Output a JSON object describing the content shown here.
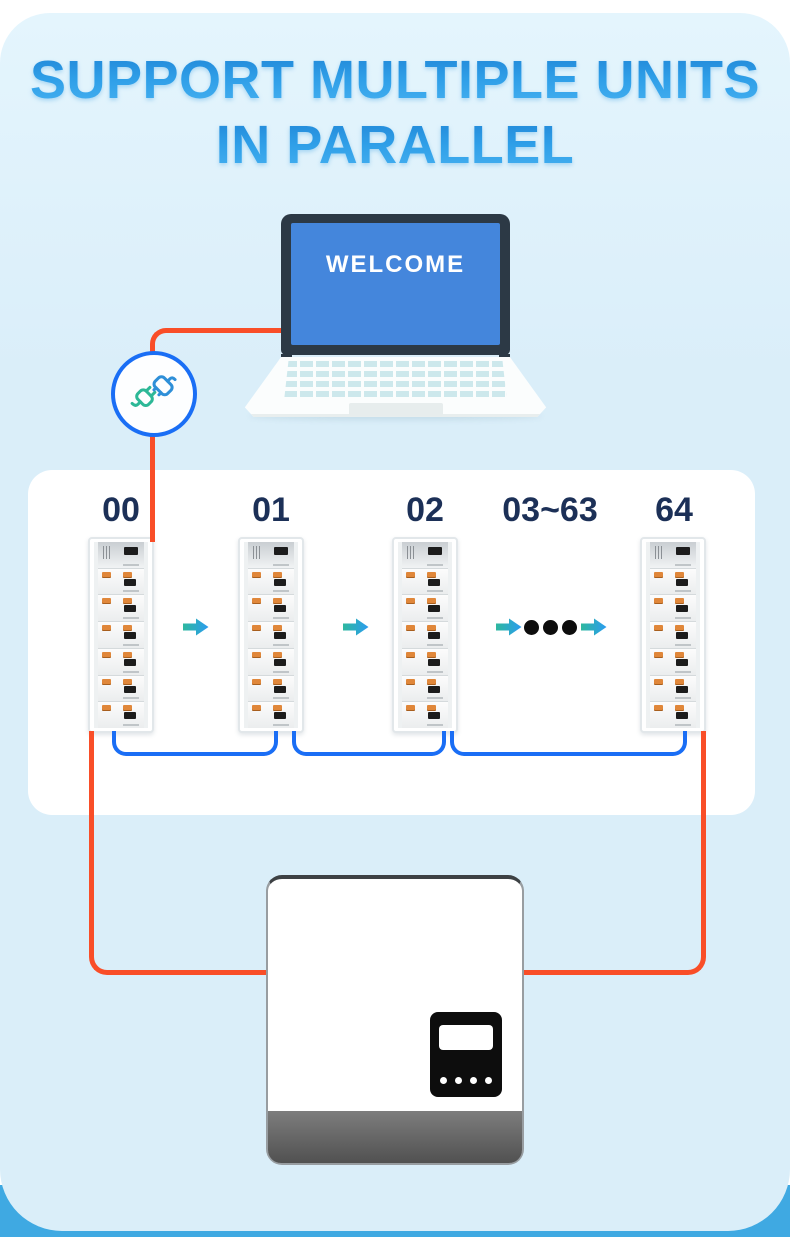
{
  "header": {
    "title_line1": "SUPPORT MULTIPLE UNITS",
    "title_line2": "IN PARALLEL"
  },
  "laptop": {
    "screen_text": "WELCOME"
  },
  "parallel_panel": {
    "unit_labels": [
      "00",
      "01",
      "02",
      "03~63",
      "64"
    ]
  },
  "icons": {
    "plug": "plug-connector-icon",
    "arrow": "arrow-right-icon",
    "ellipsis": "ellipsis-dots"
  },
  "colors": {
    "title_blue": "#2f9fe8",
    "card_light_blue": "#daeef9",
    "bottom_bar_blue": "#3fa9e2",
    "wire_orange": "#f94e28",
    "wire_blue": "#1a6ef5",
    "arrow_gradient_start": "#2eb89e",
    "arrow_gradient_end": "#2b9cf0",
    "laptop_screen_blue": "#4486dc",
    "label_navy": "#1c3057"
  }
}
